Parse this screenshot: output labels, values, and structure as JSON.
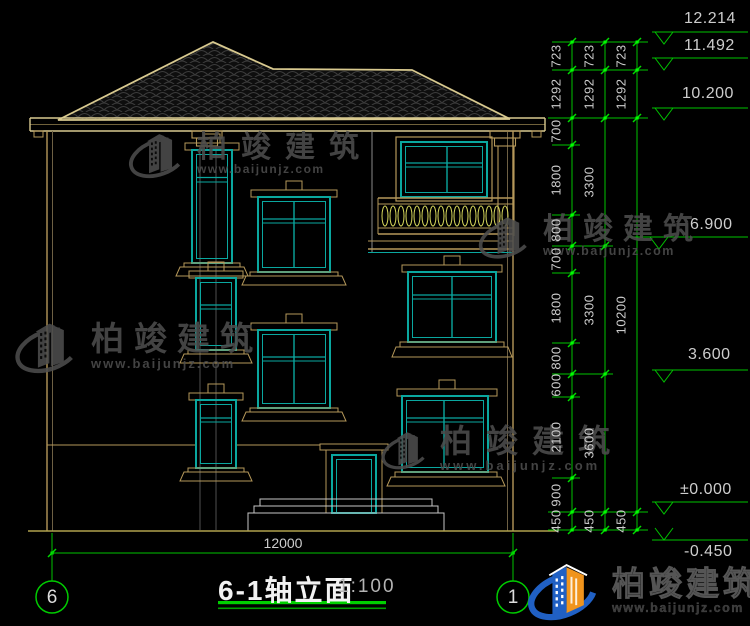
{
  "title_block": {
    "title": "6-1轴立面",
    "scale": "1:100"
  },
  "axis_bubbles": {
    "left": "6",
    "right": "1"
  },
  "dimensions": {
    "bottom": "12000",
    "col1": [
      "723",
      "1292",
      "700",
      "1800",
      "800",
      "700",
      "1800",
      "800",
      "600",
      "2100",
      "900",
      "450"
    ],
    "col2": [
      "723",
      "1292",
      "3300",
      "3300",
      "3600",
      "450"
    ],
    "col3": [
      "723",
      "1292",
      "10200",
      "450"
    ],
    "levels": [
      "12.214",
      "11.492",
      "10.200",
      "6.900",
      "3.600",
      "±0.000",
      "-0.450"
    ]
  },
  "watermark": {
    "brand": "柏竣建筑",
    "site": "www.baijunjz.com"
  },
  "footer_logo": {
    "brand": "柏竣建筑",
    "site": "www.baijunjz.com"
  },
  "colors": {
    "dim_green": "#00c300",
    "frame_teal": "#0aa79f",
    "trim_tan": "#b5985a",
    "roof_edge": "#d8c98f",
    "baluster_yellow": "#d8d85c",
    "logo_blue": "#2060c4",
    "logo_orange": "#f0941c"
  }
}
